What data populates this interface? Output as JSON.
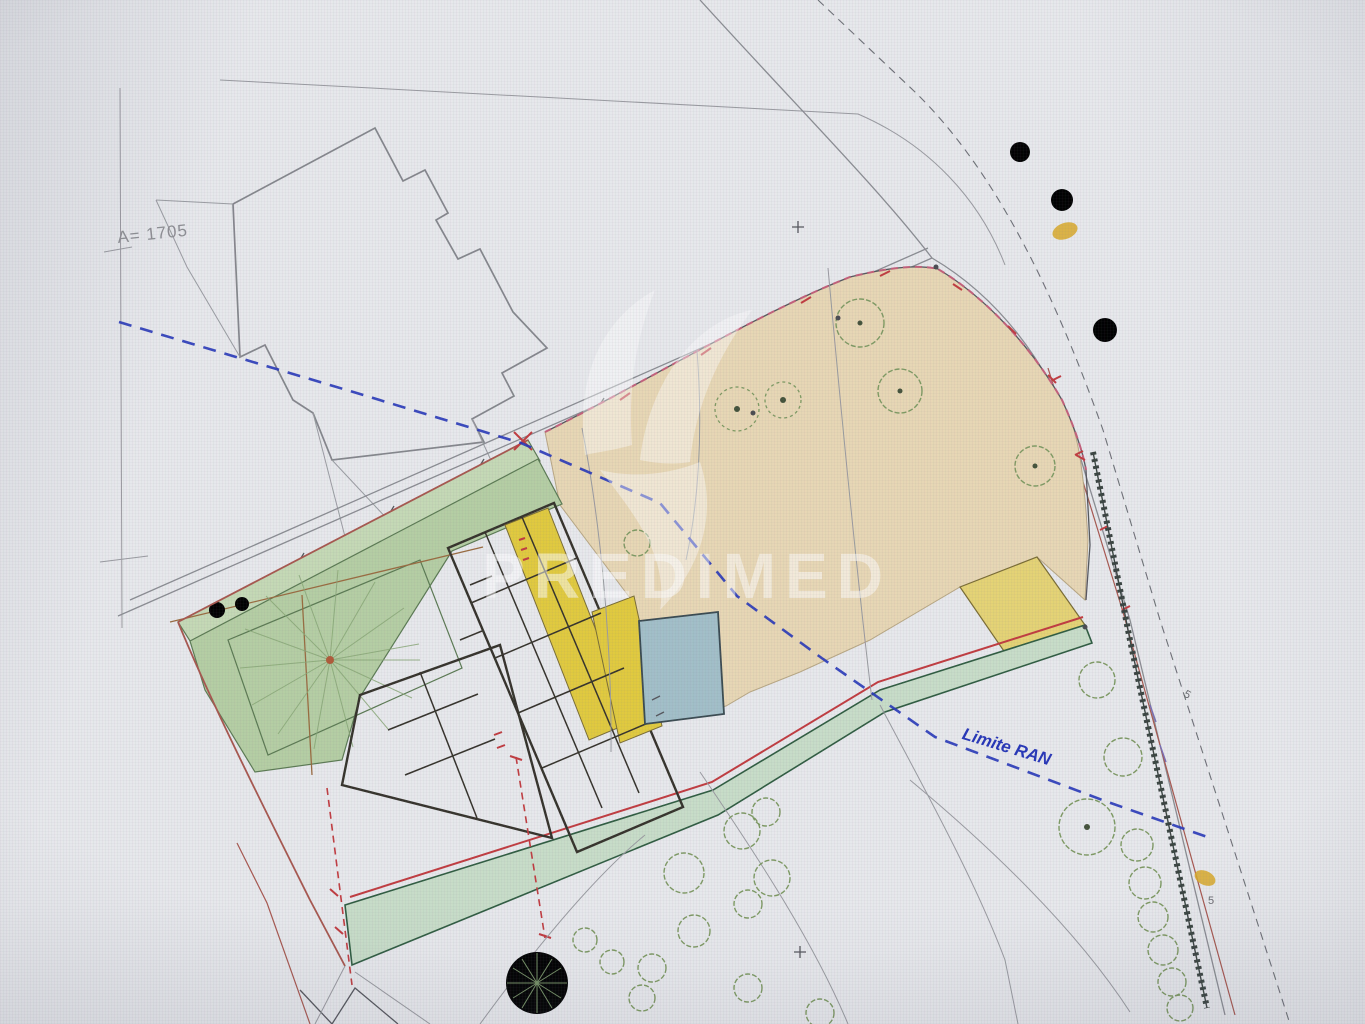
{
  "labels": {
    "area": "A= 1705",
    "ran": "Limite RAN",
    "mark_a": "5",
    "mark_b": "5"
  },
  "watermark": {
    "text": "PREDIMED"
  },
  "colors": {
    "paper": "#e9eaed",
    "photo_bg": "#e2e3e6",
    "garden_green": "#b6cfa4",
    "strip_green": "#c6dab6",
    "path_teal": "#c9dec9",
    "orchard_tan": "#e9d8b5",
    "house_yellow": "#f2e9bd",
    "highlight_yellow": "#e2cb3e",
    "accent_yellow": "#e6d475",
    "pool_blue": "#a3c0c9",
    "ran_blue": "#2636b8",
    "setback_red": "#c23b3f",
    "boundary_red": "#a8574e",
    "blob_orange": "#d9a928",
    "watermark_white": "#ffffff",
    "label_gray": "#8e8f93"
  }
}
